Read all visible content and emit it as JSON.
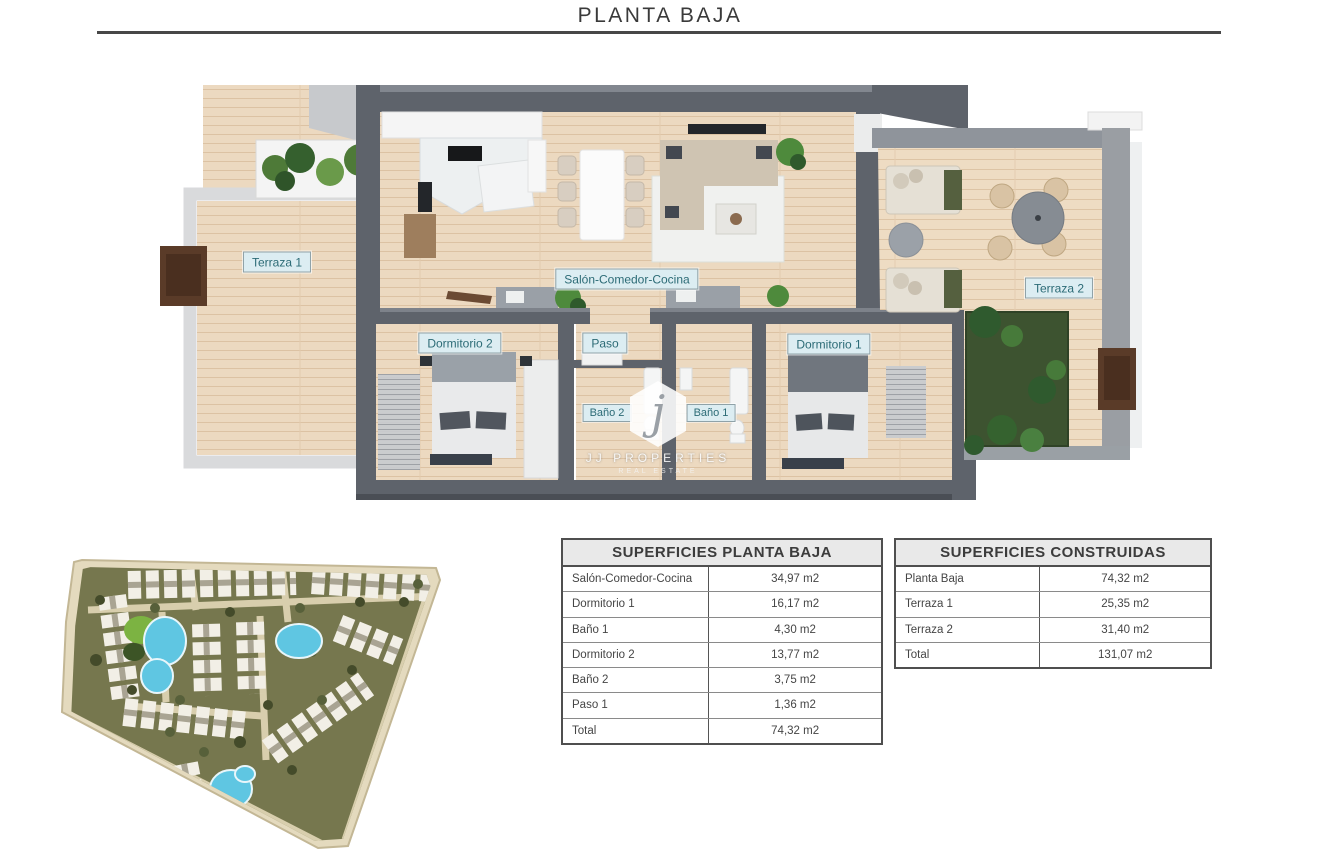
{
  "page": {
    "title": "PLANTA BAJA"
  },
  "floor_plan": {
    "room_labels": {
      "terraza1": "Terraza 1",
      "salon": "Salón-Comedor-Cocina",
      "terraza2": "Terraza 2",
      "dormitorio2": "Dormitorio 2",
      "paso": "Paso",
      "bano2": "Baño 2",
      "bano1": "Baño 1",
      "dormitorio1": "Dormitorio 1"
    },
    "watermark": {
      "logo_letter": "j",
      "brand": "JJ PROPERTIES",
      "tagline": "REAL ESTATE"
    }
  },
  "palette": {
    "wall_dark": "#5e636b",
    "wall_light": "#d9dadc",
    "floor_wood": "#ecd9c0",
    "lawn_green": "#3d5330",
    "pool_blue": "#5fc6e2",
    "site_olive": "#76774e",
    "label_bg": "#dcedf2",
    "label_text": "#2c6b76",
    "divider": "#474747"
  },
  "tables": [
    {
      "title": "SUPERFICIES PLANTA BAJA",
      "rows": [
        {
          "label": "Salón-Comedor-Cocina",
          "value": "34,97 m2"
        },
        {
          "label": "Dormitorio 1",
          "value": "16,17 m2"
        },
        {
          "label": "Baño 1",
          "value": "4,30 m2"
        },
        {
          "label": "Dormitorio 2",
          "value": "13,77 m2"
        },
        {
          "label": "Baño 2",
          "value": "3,75 m2"
        },
        {
          "label": "Paso 1",
          "value": "1,36 m2"
        },
        {
          "label": "Total",
          "value": "74,32 m2"
        }
      ]
    },
    {
      "title": "SUPERFICIES CONSTRUIDAS",
      "rows": [
        {
          "label": "Planta Baja",
          "value": "74,32 m2"
        },
        {
          "label": "Terraza 1",
          "value": "25,35 m2"
        },
        {
          "label": "Terraza 2",
          "value": "31,40 m2"
        },
        {
          "label": "Total",
          "value": "131,07 m2"
        }
      ]
    }
  ]
}
